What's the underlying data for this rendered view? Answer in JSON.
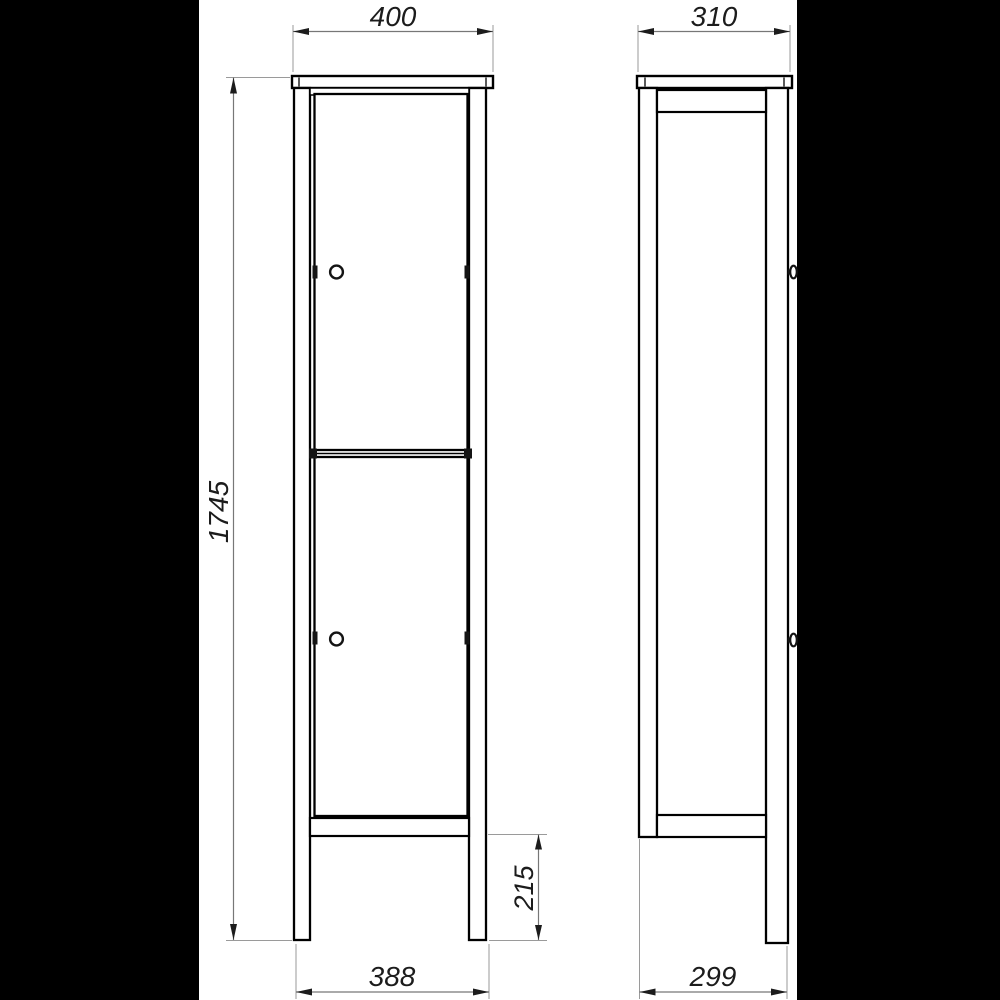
{
  "colors": {
    "matte_background": "#000000",
    "paper": "#ffffff",
    "outline": "#000000",
    "detail": "#141414",
    "dimension_line": "#777777",
    "extension_line": "#9a9a9a",
    "dimension_text": "#1c1c1c"
  },
  "views": {
    "front": {
      "dims": {
        "top_width": "400",
        "overall_height": "1745",
        "leg_height": "215",
        "bottom_width": "388"
      }
    },
    "side": {
      "dims": {
        "top_depth": "310",
        "bottom_depth": "299"
      }
    }
  }
}
